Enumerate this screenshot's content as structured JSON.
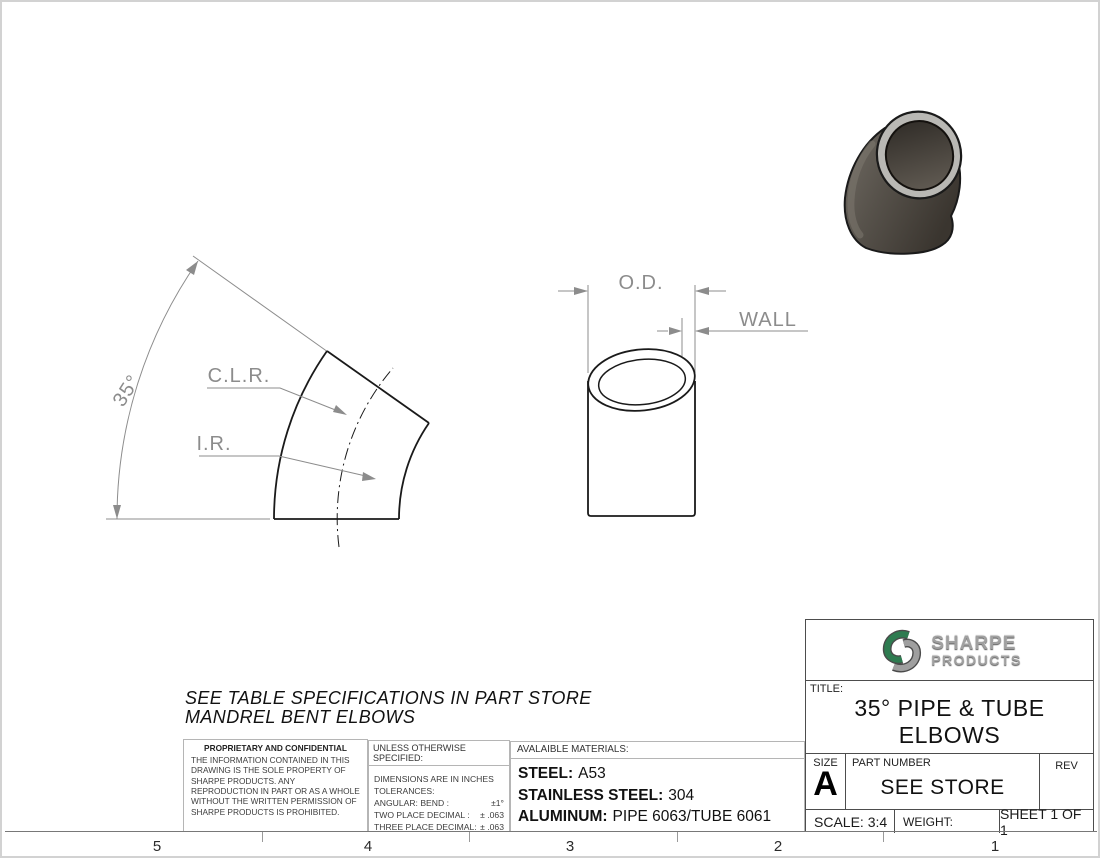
{
  "drawing_labels": {
    "angle": "35°",
    "clr": "C.L.R.",
    "ir": "I.R.",
    "od": "O.D.",
    "wall": "WALL"
  },
  "note": {
    "line1": "SEE TABLE SPECIFICATIONS IN PART STORE",
    "line2": "MANDREL BENT ELBOWS"
  },
  "proprietary": {
    "header": "PROPRIETARY AND CONFIDENTIAL",
    "body": "THE INFORMATION CONTAINED IN THIS DRAWING IS THE SOLE PROPERTY OF SHARPE PRODUCTS.  ANY REPRODUCTION IN PART OR AS A WHOLE WITHOUT THE WRITTEN PERMISSION OF SHARPE PRODUCTS IS PROHIBITED."
  },
  "tolerances": {
    "header": "UNLESS OTHERWISE SPECIFIED:",
    "line1": "DIMENSIONS ARE IN INCHES",
    "line2": "TOLERANCES:",
    "rows": [
      {
        "label": "ANGULAR: BEND :",
        "value": "±1°"
      },
      {
        "label": "TWO PLACE DECIMAL  :",
        "value": "± .063"
      },
      {
        "label": "THREE PLACE DECIMAL:",
        "value": "± .063"
      }
    ]
  },
  "materials": {
    "header": "AVALAIBLE MATERIALS:",
    "items": [
      {
        "label": "STEEL:",
        "value": "A53"
      },
      {
        "label": "STAINLESS STEEL:",
        "value": "304"
      },
      {
        "label": "ALUMINUM:",
        "value": "PIPE 6063/TUBE 6061"
      }
    ]
  },
  "title_block": {
    "logo_line1": "SHARPE",
    "logo_line2": "PRODUCTS",
    "title_label": "TITLE:",
    "title_line1": "35° PIPE & TUBE",
    "title_line2": "ELBOWS",
    "size_label": "SIZE",
    "size_value": "A",
    "part_number_label": "PART NUMBER",
    "part_number_value": "SEE STORE",
    "rev_label": "REV",
    "scale": "SCALE: 3:4",
    "weight": "WEIGHT:",
    "sheet": "SHEET 1 OF 1"
  },
  "border_numbers": [
    "5",
    "4",
    "3",
    "2",
    "1"
  ],
  "colors": {
    "logo_green": "#2e7b50",
    "logo_silver": "#a0a0a0",
    "dimension_gray": "#8c8c8c",
    "edge_black": "#1a1a1a"
  }
}
